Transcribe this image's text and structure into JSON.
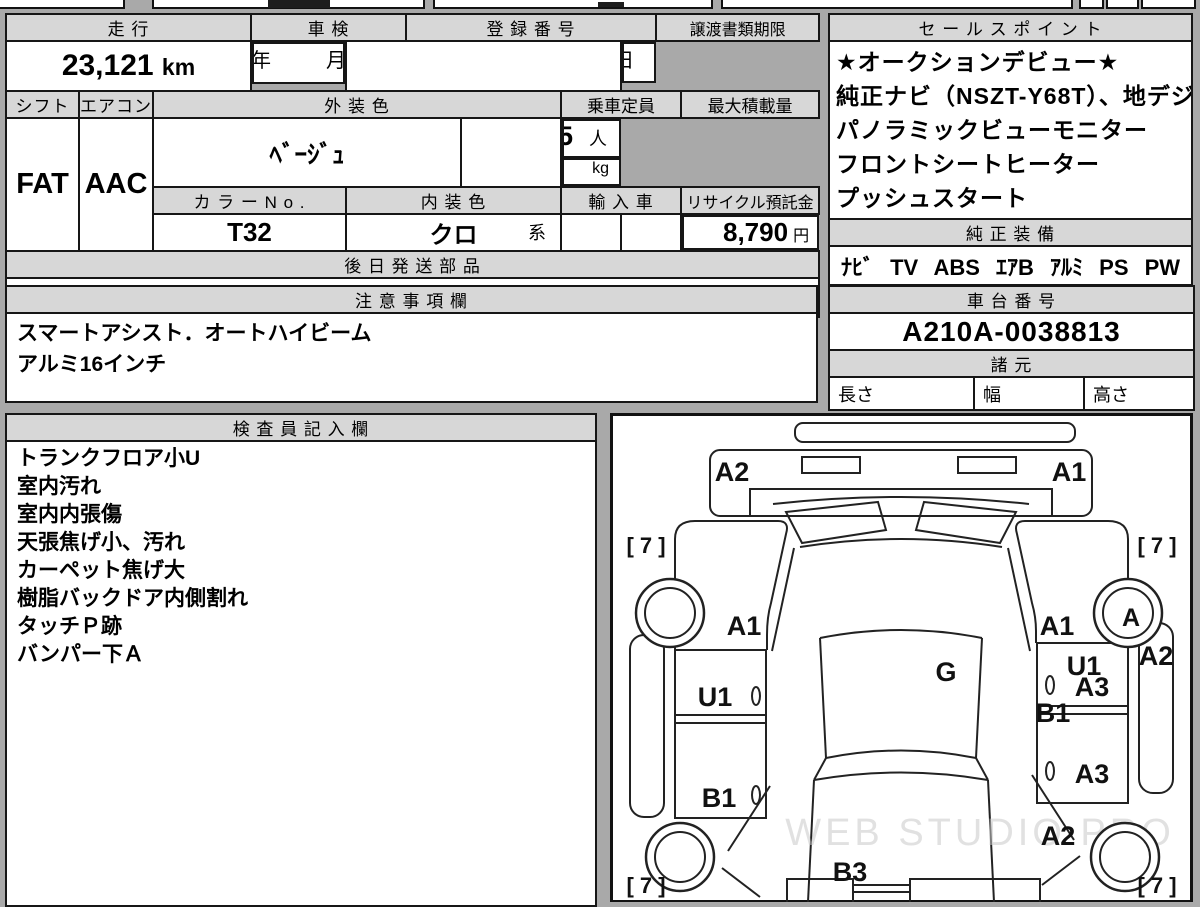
{
  "info": {
    "mileage_label": "走 行",
    "mileage_value": "23,121",
    "mileage_unit": "km",
    "inspection_label": "車 検",
    "inspection_year": "年",
    "inspection_month": "月",
    "registration_label": "登 録 番 号",
    "deadline_label": "譲渡書類期限",
    "deadline_month": "月",
    "deadline_day": "日",
    "shift_label": "シフト",
    "shift_value": "FAT",
    "aircon_label": "エアコン",
    "aircon_value": "AAC",
    "ext_color_label": "外 装 色",
    "ext_color_value": "ﾍﾞｰｼﾞｭ",
    "capacity_label": "乗車定員",
    "capacity_value": "5",
    "capacity_unit": "人",
    "max_load_label": "最大積載量",
    "max_load_unit": "kg",
    "color_no_label": "カ ラ ー N o .",
    "color_no_value": "T32",
    "int_color_label": "内 装 色",
    "int_color_value": "クロ",
    "int_color_suffix": "系",
    "import_label": "輸 入 車",
    "recycle_label": "リサイクル預託金",
    "recycle_value": "8,790",
    "recycle_unit": "円",
    "later_parts_label": "後 日 発 送 部 品",
    "later_parts_value": "保証書 車両取説 ﾅﾋﾞ取説"
  },
  "sales": {
    "title": "セ ー ル ス ポ イ ン ト",
    "lines": [
      "★オークションデビュー★",
      "純正ナビ（NSZT-Y68T）、地デジ",
      "パノラミックビューモニター",
      "フロントシートヒーター",
      "プッシュスタート"
    ]
  },
  "equipment": {
    "title": "純 正 装 備",
    "value": "ﾅﾋﾞ TV ABS ｴｱB ｱﾙﾐ PS PW"
  },
  "notes": {
    "title": "注 意 事 項 欄",
    "lines": [
      "スマートアシスト．オートハイビーム",
      "アルミ16インチ"
    ]
  },
  "chassis": {
    "title": "車 台 番 号",
    "value": "A210A-0038813"
  },
  "specs": {
    "title": "諸 元",
    "length": "長さ",
    "width": "幅",
    "height": "高さ"
  },
  "inspector": {
    "title": "検 査 員 記 入 欄",
    "lines": [
      "トランクフロア小U",
      "室内汚れ",
      "室内内張傷",
      "天張焦げ小、汚れ",
      "カーペット焦げ大",
      "樹脂バックドア内側割れ",
      "タッチＰ跡",
      "バンパー下Ａ"
    ]
  },
  "diagram": {
    "watermark": "WEB STUDIO PRO",
    "corner_grade": "[ 7 ]",
    "marks": {
      "front_panel_left": "A2",
      "front_panel_right": "A1",
      "fender_left": "A1",
      "fender_right": "A1",
      "wheel_front_right": "A",
      "roof": "G",
      "door_left_front": "U1",
      "door_right_top": "U1",
      "door_right_front": "A3",
      "pillar_right": "B1",
      "door_left_rear": "B1",
      "door_right_rear": "A3",
      "side_right": "A2",
      "quarter_right": "A2",
      "rear_gate": "B3"
    }
  }
}
